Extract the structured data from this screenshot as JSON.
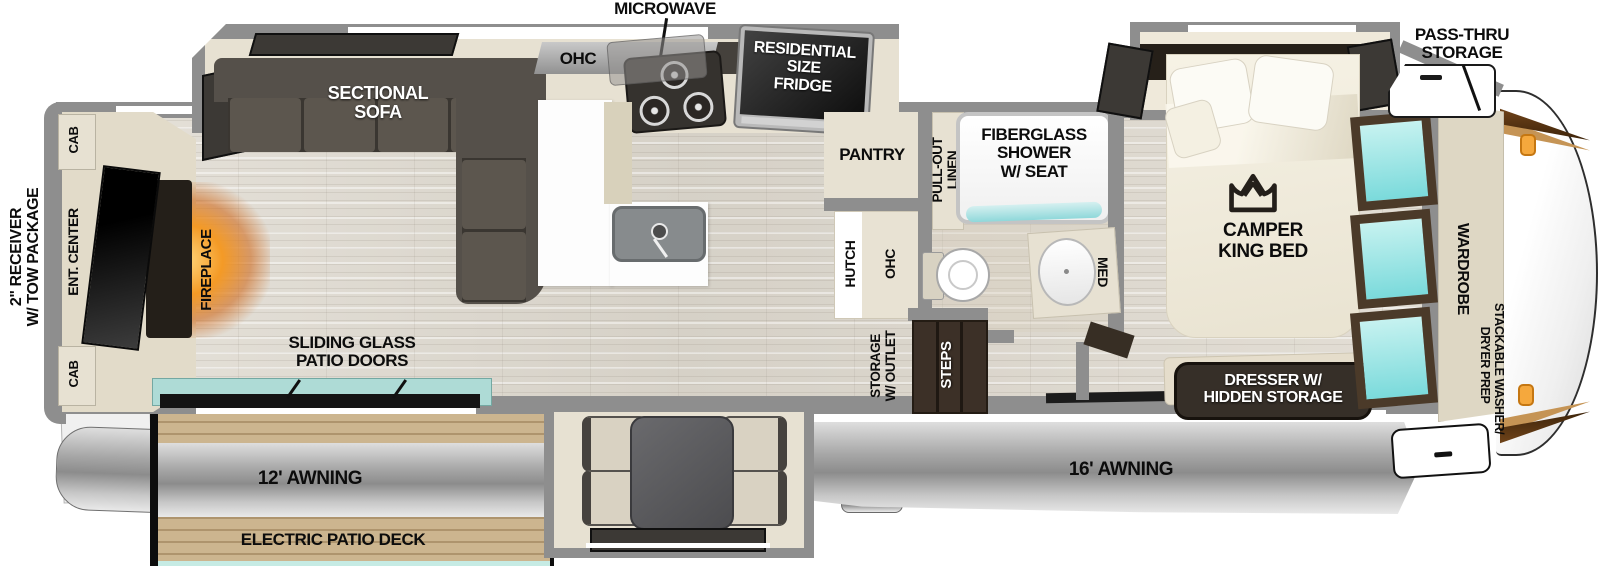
{
  "colors": {
    "wall_gray": "#8e8e8e",
    "accent_teal": "#8fd8da",
    "accent_orange": "#f5a83d",
    "sofa_dark": "#55504a",
    "deck_wood": "#ccb58f",
    "fireplace_glow": "#f49a26"
  },
  "exterior": {
    "receiver_line1": "2\" RECEIVER",
    "receiver_line2": "W/ TOW PACKAGE",
    "pass_thru_line1": "PASS-THRU",
    "pass_thru_line2": "STORAGE",
    "awning_rear": "12' AWNING",
    "awning_main": "16' AWNING",
    "patio_deck": "ELECTRIC PATIO DECK",
    "patio_doors_line1": "SLIDING GLASS",
    "patio_doors_line2": "PATIO DOORS"
  },
  "living": {
    "sofa_line1": "SECTIONAL",
    "sofa_line2": "SOFA",
    "fireplace": "FIREPLACE",
    "ent_center": "ENT. CENTER",
    "cab_top": "CAB",
    "cab_bottom": "CAB"
  },
  "kitchen": {
    "microwave": "MICROWAVE",
    "ohc": "OHC",
    "fridge_line1": "RESIDENTIAL",
    "fridge_line2": "SIZE",
    "fridge_line3": "FRIDGE",
    "pantry": "PANTRY",
    "hutch": "HUTCH",
    "hutch_ohc": "OHC"
  },
  "bath": {
    "linen_line1": "PULL-OUT",
    "linen_line2": "LINEN",
    "shower_line1": "FIBERGLASS",
    "shower_line2": "SHOWER",
    "shower_line3": "W/ SEAT",
    "med": "MED"
  },
  "entry": {
    "storage_line1": "STORAGE",
    "storage_line2": "W/ OUTLET",
    "steps": "STEPS"
  },
  "bedroom": {
    "bed_line1": "CAMPER",
    "bed_line2": "KING BED",
    "dresser_line1": "DRESSER W/",
    "dresser_line2": "HIDDEN STORAGE",
    "wardrobe": "WARDROBE",
    "washer_line1": "STACKABLE WASHER/",
    "washer_line2": "DRYER PREP"
  }
}
